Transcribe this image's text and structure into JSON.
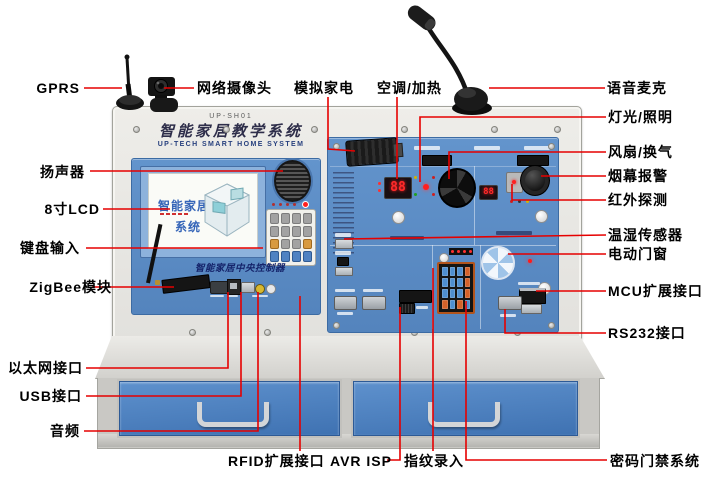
{
  "colors": {
    "callout_red": "#e60000",
    "panel_blue": "#5b8cc4",
    "drawer_blue": "#4a7fc0",
    "cabinet_gray": "#c9c8c4",
    "frame_gray": "#e9e8e4",
    "led_red": "#ff2222"
  },
  "device": {
    "model": "UP-SH01",
    "title_cn": "智能家居教学系统",
    "title_en": "UP-TECH SMART HOME SYSTEM",
    "lcd": {
      "line1": "智能家居",
      "line2": "系统"
    },
    "controller_caption": "智能家居中央控制器",
    "ac_display": "88",
    "env_display": "88"
  },
  "labels": [
    {
      "id": "gprs",
      "text": "GPRS"
    },
    {
      "id": "network-camera",
      "text": "网络摄像头"
    },
    {
      "id": "simulated-appliance",
      "text": "模拟家电"
    },
    {
      "id": "ac-heating",
      "text": "空调/加热"
    },
    {
      "id": "voice-mic",
      "text": "语音麦克"
    },
    {
      "id": "speaker",
      "text": "扬声器"
    },
    {
      "id": "lcd-8inch",
      "text": "8寸LCD"
    },
    {
      "id": "keypad-input",
      "text": "键盘输入"
    },
    {
      "id": "zigbee-module",
      "text": "ZigBee模块"
    },
    {
      "id": "ethernet-port",
      "text": "以太网接口"
    },
    {
      "id": "usb-port",
      "text": "USB接口"
    },
    {
      "id": "audio",
      "text": "音频"
    },
    {
      "id": "rfid-expansion",
      "text": "RFID扩展接口"
    },
    {
      "id": "avr-isp",
      "text": "AVR ISP"
    },
    {
      "id": "fingerprint",
      "text": "指纹录入"
    },
    {
      "id": "password-door",
      "text": "密码门禁系统"
    },
    {
      "id": "lighting",
      "text": "灯光/照明"
    },
    {
      "id": "fan-ventilation",
      "text": "风扇/换气"
    },
    {
      "id": "smoke-alarm",
      "text": "烟幕报警"
    },
    {
      "id": "ir-detection",
      "text": "红外探测"
    },
    {
      "id": "temp-humidity",
      "text": "温湿传感器"
    },
    {
      "id": "electric-window",
      "text": "电动门窗"
    },
    {
      "id": "mcu-expansion",
      "text": "MCU扩展接口"
    },
    {
      "id": "rs232",
      "text": "RS232接口"
    }
  ]
}
